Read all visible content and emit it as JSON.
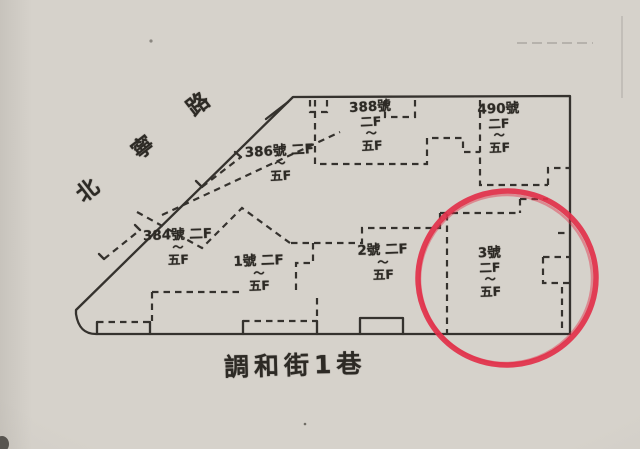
{
  "streets": {
    "diagonal_road": "北寧路",
    "bottom_lane": "調和街1巷"
  },
  "units": [
    {
      "name": "unit-388",
      "lines": [
        "388號",
        "二F",
        "～",
        "五F"
      ]
    },
    {
      "name": "unit-490",
      "lines": [
        "490號",
        "二F",
        "～",
        "五F"
      ]
    },
    {
      "name": "unit-386",
      "lines": [
        "386號 二F",
        "～",
        "五F"
      ]
    },
    {
      "name": "unit-384",
      "lines": [
        "384號 二F",
        "～",
        "五F"
      ]
    },
    {
      "name": "unit-1",
      "lines": [
        "1號 二F",
        "～",
        "五F"
      ]
    },
    {
      "name": "unit-2",
      "lines": [
        "2號 二F",
        "～",
        "五F"
      ]
    },
    {
      "name": "unit-3",
      "lines": [
        "3號",
        "二F",
        "～",
        "五F"
      ]
    }
  ],
  "annotation": {
    "kind": "hand-drawn red circle",
    "highlighted_unit": "3號",
    "color": "#e2304a"
  },
  "colors": {
    "paper": "#d6d2cb",
    "ink": "#34312d",
    "annotation_red": "#e2304a"
  }
}
